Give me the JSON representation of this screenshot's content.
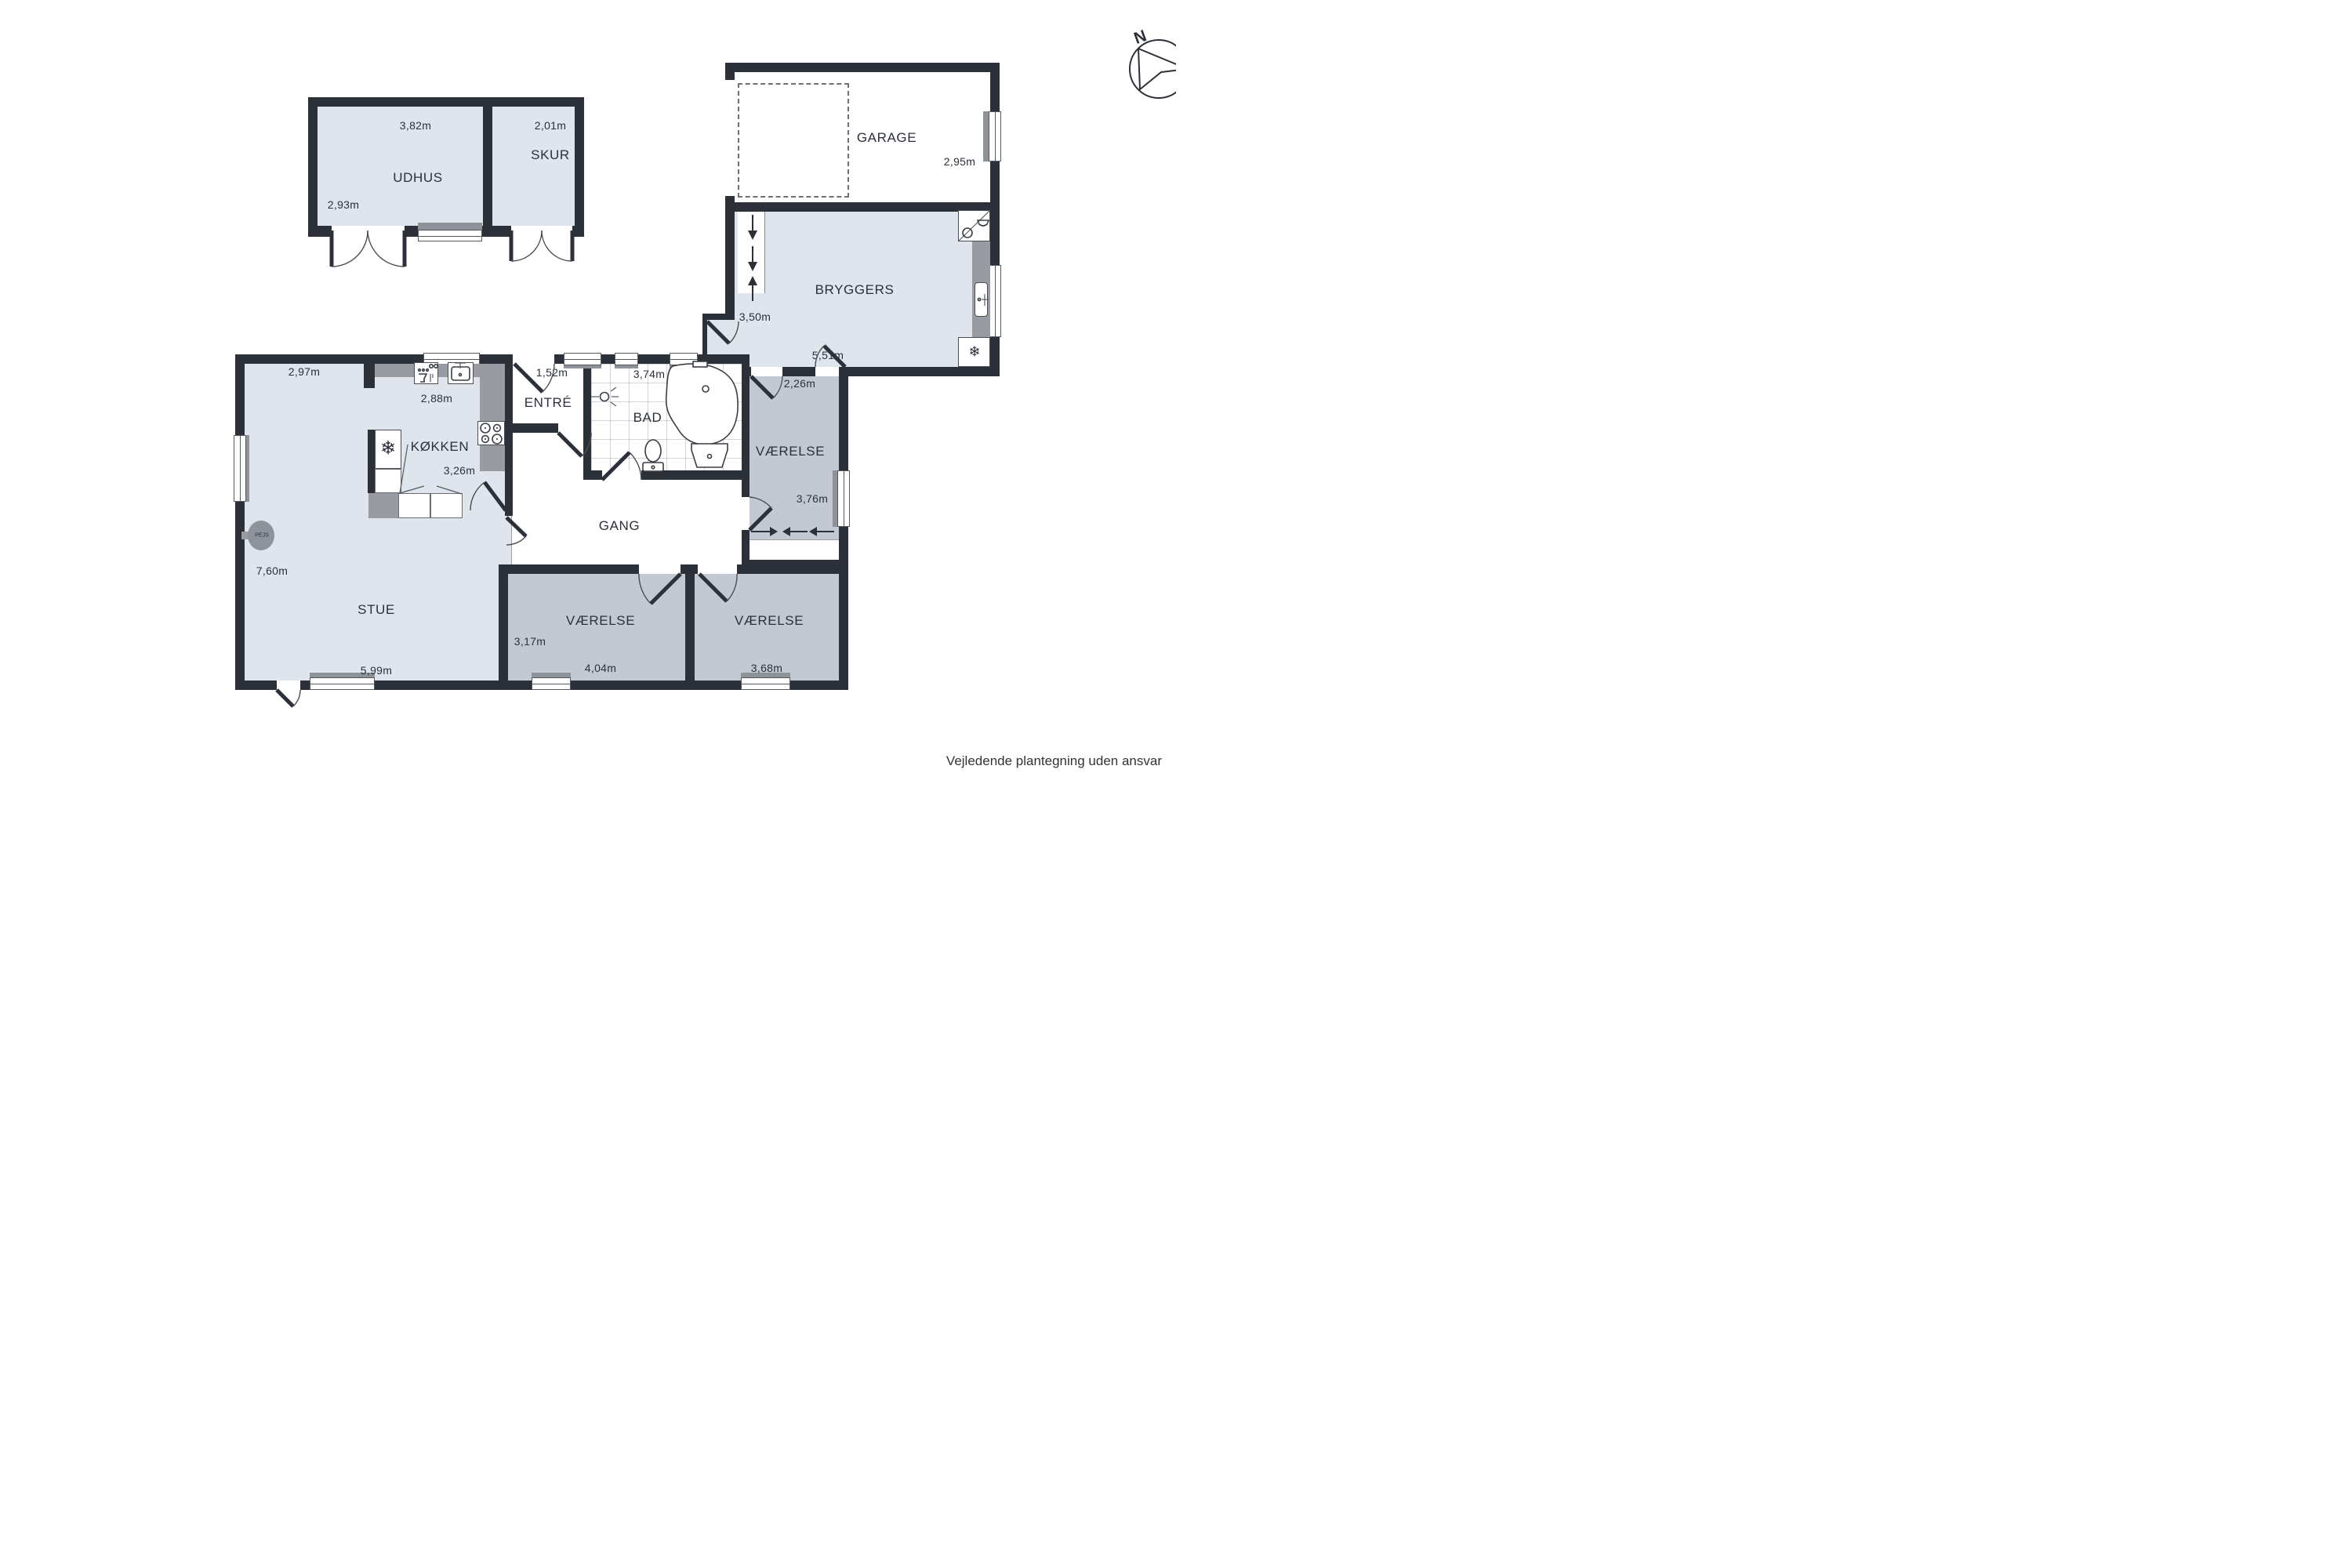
{
  "disclaimer": "Vejledende plantegning uden ansvar",
  "compass": {
    "label": "N"
  },
  "colors": {
    "wall": "#2c3038",
    "floor_light": "#dfe4ed",
    "floor_gray": "#c3c8d2",
    "counter": "#989ba1",
    "accent_text": "#2b303b"
  },
  "icons": {
    "freezer_symbol": "❄"
  },
  "rooms": {
    "udhus": {
      "label": "UDHUS",
      "dim_width": "3,82m",
      "dim_height": "2,93m"
    },
    "skur": {
      "label": "SKUR",
      "dim_width": "2,01m"
    },
    "garage": {
      "label": "GARAGE",
      "dim_height": "2,95m"
    },
    "bryggers": {
      "label": "BRYGGERS",
      "dim_height": "3,50m",
      "dim_width": "5,51m"
    },
    "entre": {
      "label": "ENTRÉ",
      "dim_width": "1,52m"
    },
    "bad": {
      "label": "BAD",
      "dim_width": "3,74m"
    },
    "koekken": {
      "label": "KØKKEN",
      "dim_width": "2,88m",
      "dim_height": "3,26m"
    },
    "stue": {
      "label": "STUE",
      "dim_top": "2,97m",
      "dim_height": "7,60m",
      "dim_width": "5,99m"
    },
    "gang": {
      "label": "GANG"
    },
    "vaerelse_ne": {
      "label": "VÆRELSE",
      "dim_width": "2,26m",
      "dim_height": "3,76m"
    },
    "vaerelse_sw": {
      "label": "VÆRELSE",
      "dim_height": "3,17m",
      "dim_width": "4,04m"
    },
    "vaerelse_se": {
      "label": "VÆRELSE",
      "dim_width": "3,68m"
    },
    "pejs": {
      "label": "PEJS"
    }
  }
}
